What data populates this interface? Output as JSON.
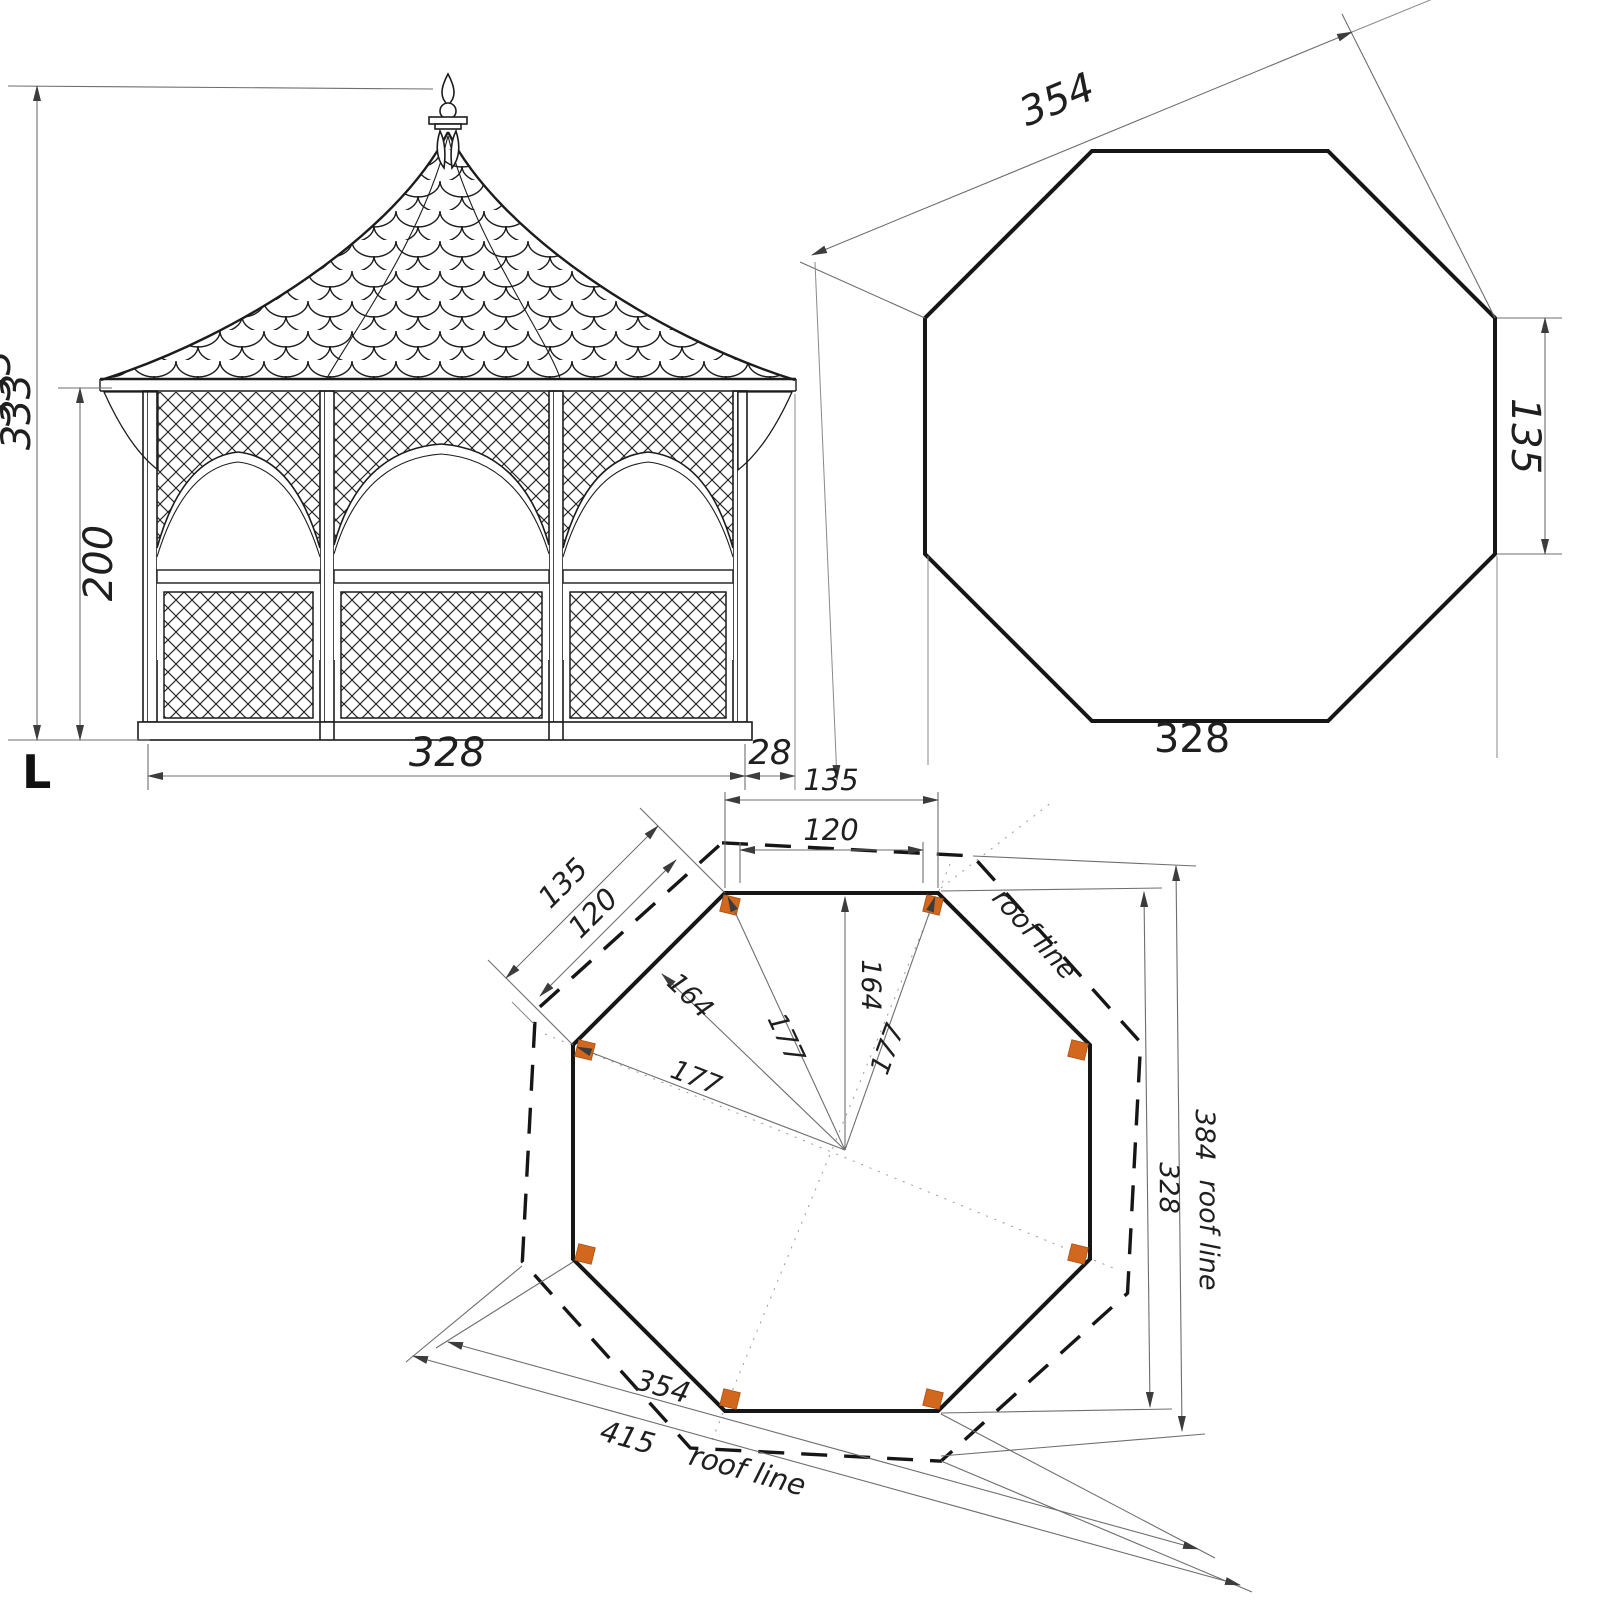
{
  "colors": {
    "line": "#1c1c1c",
    "dimension_line": "#6e6e6e",
    "post": "#d2681e",
    "background": "#ffffff"
  },
  "elevation": {
    "total_height": "333",
    "total_height_partial": "333",
    "wall_height": "200",
    "base_width": "328",
    "eave_overhang": "28",
    "corner_mark": "L"
  },
  "octagon_plan": {
    "across_corners": "354",
    "side_length": "135",
    "across_flats": "328"
  },
  "floor_plan": {
    "top_span_outer": "135",
    "top_span_inner": "120",
    "diag_span_outer": "135",
    "diag_span_inner": "120",
    "apothem_vertical": "164",
    "apothem_diagonal": "164",
    "radius_top_left": "177",
    "radius_top_right": "177",
    "radius_left": "177",
    "across_flats": "328",
    "across_corners": "354",
    "roof_across_flats": "384",
    "roof_across_flats_word": "roof line",
    "roof_across_corners": "415",
    "roof_across_corners_word": "roof line",
    "roof_edge_label": "roof line"
  }
}
